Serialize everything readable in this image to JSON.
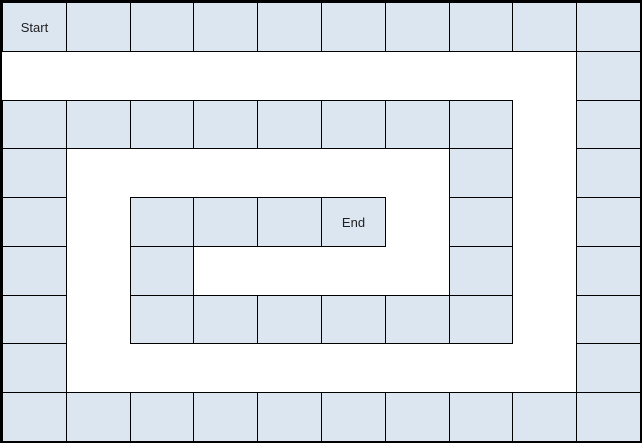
{
  "board": {
    "columns": 10,
    "rows": 9,
    "colors": {
      "cell_fill": "#dce6f1",
      "grid_line": "#000000",
      "outer_border": "#000000",
      "background": "#ffffff",
      "label_text": "#1f1f1f"
    },
    "start": {
      "row": 0,
      "col": 0,
      "label": "Start"
    },
    "end": {
      "row": 4,
      "col": 5,
      "label": "End"
    },
    "filled_rows": [
      {
        "row": 0,
        "cols": [
          0,
          1,
          2,
          3,
          4,
          5,
          6,
          7,
          8,
          9
        ]
      },
      {
        "row": 1,
        "cols": [
          9
        ]
      },
      {
        "row": 2,
        "cols": [
          0,
          1,
          2,
          3,
          4,
          5,
          6,
          7,
          9
        ]
      },
      {
        "row": 3,
        "cols": [
          0,
          7,
          9
        ]
      },
      {
        "row": 4,
        "cols": [
          0,
          2,
          3,
          4,
          5,
          7,
          9
        ]
      },
      {
        "row": 5,
        "cols": [
          0,
          2,
          7,
          9
        ]
      },
      {
        "row": 6,
        "cols": [
          0,
          2,
          3,
          4,
          5,
          6,
          7,
          9
        ]
      },
      {
        "row": 7,
        "cols": [
          0,
          9
        ]
      },
      {
        "row": 8,
        "cols": [
          0,
          1,
          2,
          3,
          4,
          5,
          6,
          7,
          8,
          9
        ]
      }
    ]
  }
}
